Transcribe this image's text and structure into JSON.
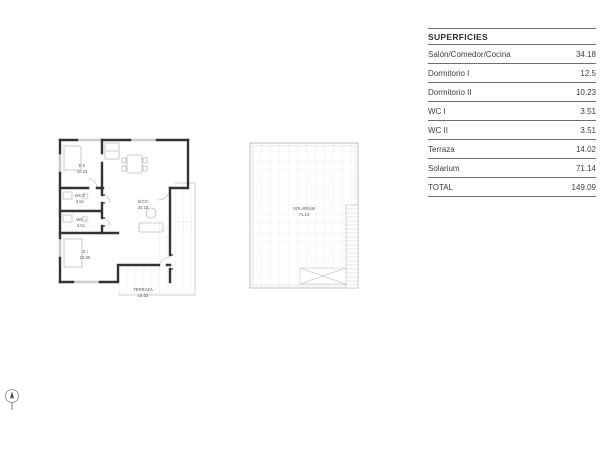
{
  "window": {
    "width": 600,
    "height": 450,
    "background": "#ffffff"
  },
  "surfaces_table": {
    "title": "SUPERFICIES",
    "rows": [
      {
        "label": "Salón/Comedor/Cocina",
        "value": "34.18"
      },
      {
        "label": "Dormitorio I",
        "value": "12.5"
      },
      {
        "label": "Dormitorio II",
        "value": "10.23"
      },
      {
        "label": "WC I",
        "value": "3.51"
      },
      {
        "label": "WC II",
        "value": "3.51"
      },
      {
        "label": "Terraza",
        "value": "14.02"
      },
      {
        "label": "Solarium",
        "value": "71.14"
      },
      {
        "label": "TOTAL",
        "value": "149.09"
      }
    ]
  },
  "apartment_plan": {
    "rooms": [
      {
        "name": "D II",
        "area": "10.23"
      },
      {
        "name": "WC II",
        "area": "3.51"
      },
      {
        "name": "WC I",
        "area": "3.51"
      },
      {
        "name": "D I",
        "area": "12.50"
      },
      {
        "name": "S/C/C",
        "area": "34.18"
      },
      {
        "name": "TERRAZA",
        "area": "14.02"
      }
    ]
  },
  "solarium_plan": {
    "room": {
      "name": "SOLARIUM",
      "area": "71.14"
    }
  },
  "icons": {
    "north_arrow": "north-arrow"
  },
  "colors": {
    "wall": "#333333",
    "thin_line": "#c0c0c0",
    "grid_line": "#e3e3e3",
    "plan_text": "#555555",
    "table_text": "#3d3d3d",
    "table_rule": "#6e6e6e"
  }
}
